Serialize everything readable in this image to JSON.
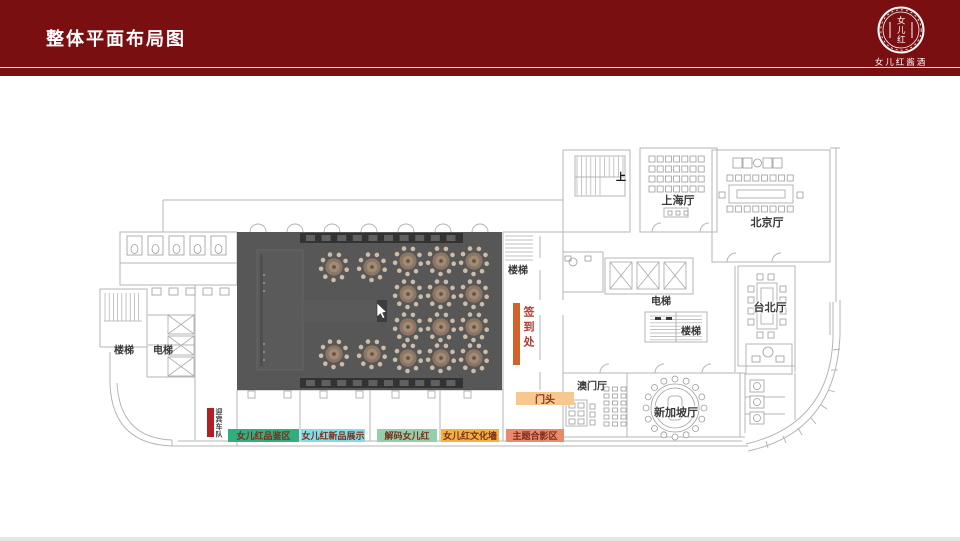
{
  "header": {
    "title": "整体平面布局图",
    "bg": "#7a0f12",
    "logo_seal_text": "女儿红",
    "logo_text": "女儿红酱酒"
  },
  "plan": {
    "rooms": {
      "shanghai": "上海厅",
      "beijing": "北京厅",
      "taipei": "台北厅",
      "macau": "澳门厅",
      "singapore": "新加坡厅",
      "elevator_left": "电梯",
      "elevator_right": "电梯",
      "stairs_left": "楼梯",
      "stairs_mid": "楼梯",
      "stairs_right": "楼梯",
      "up": "上"
    },
    "callouts": {
      "checkin": {
        "label": "签到处",
        "bar_color": "#d0622b",
        "text_color": "#b03a2e"
      },
      "entrance": {
        "label": "门头",
        "bar_color": "#f6c88e",
        "text_color": "#8a2f1d"
      },
      "motorcade": {
        "label": "迎宾车队",
        "bar_color": "#b21f24",
        "text_color": "#414141"
      }
    },
    "zones": [
      {
        "label": "女儿红品鉴区",
        "color": "#2fae7e"
      },
      {
        "label": "女儿红新品展示",
        "color": "#7fdfe9"
      },
      {
        "label": "解码女儿红",
        "color": "#92cfaa"
      },
      {
        "label": "女儿红文化墙",
        "color": "#f3b23d"
      },
      {
        "label": "主题合影区",
        "color": "#e98a6d"
      }
    ]
  }
}
